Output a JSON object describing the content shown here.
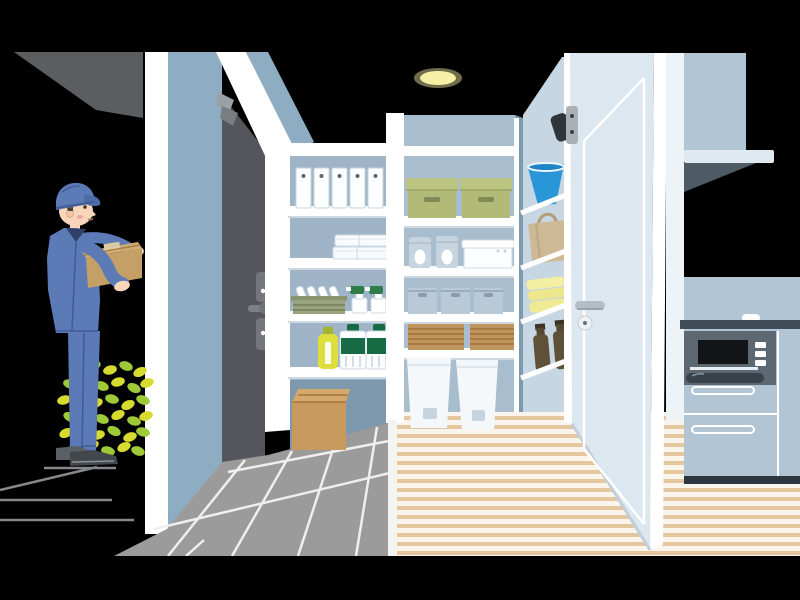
{
  "meta": {
    "type": "flat vector illustration",
    "description": "Delivery worker in blue uniform and cap handing a cardboard parcel at the open dark entrance door of a home; walk-through pantry with stocked white shelving in the center; open white interior door leading to a kitchen with range hood and built-in oven on the right; ceiling downlight glowing above.",
    "canvas": {
      "width": 800,
      "height": 600
    }
  },
  "scene": {
    "exterior": {
      "elements": [
        "dark porch overhang",
        "concrete step edges",
        "green shrub by the step"
      ],
      "person": {
        "role": "delivery-worker",
        "outfit": "blue work jacket, blue trousers, blue cap, dark shoes",
        "holding": "cardboard parcel with packing tape",
        "facing": "right toward the open door"
      }
    },
    "entrance": {
      "door": "dark gray entry door opened outward",
      "hardware": [
        "edge lock cylinders with thumb turns",
        "lever handle",
        "door closer bracket"
      ],
      "floor": "gray tile entryway with white grout lines"
    },
    "pantry": {
      "left_shelf_items": [
        "five white file binders",
        "stacked white storage containers",
        "olive basket with white plates",
        "two spray bottles with green triggers",
        "yellow detergent bottle",
        "two white bottles with green labels",
        "cardboard box on the floor"
      ],
      "center_shelf_items": [
        "two green storage boxes",
        "two soft pouches and a white sealed container",
        "three fabric storage cubes",
        "two woven rattan cases",
        "two white pedal bins on the floor"
      ],
      "corner_shelf_items": [
        "blue bucket",
        "kraft carry bag",
        "three folded yellow towels",
        "two brown bottles"
      ],
      "floor": "pale wood floor with plank stripes",
      "counts": {
        "binders": 5,
        "green_boxes": 2,
        "fabric_cubes": 3,
        "rattan_cases": 2,
        "pedal_bins": 2,
        "towels": 3,
        "brown_bottles": 2,
        "spray_bottles": 2,
        "label_bottles": 2
      }
    },
    "kitchen": {
      "door": "white interior door opened toward viewer with inset panel line, lever handle and round lock",
      "elements": [
        "range hood / upper cabinet",
        "light shelf with dark underside",
        "counter with dark edge",
        "built-in oven with black window and three buttons",
        "drawer fronts with white handle outlines",
        "dark toe kick",
        "striped wood floor"
      ]
    },
    "lighting": "single warm ceiling downlight glow"
  },
  "palette": {
    "background": "#000000",
    "porch_overhang": "#5a5e61",
    "porch_line": "#85898c",
    "exterior_wall_white": "#ffffff",
    "entry_jamb_blue": "#8fadc2",
    "entry_door_dark": "#54565b",
    "door_hardware_gray": "#73767c",
    "pantry_wall": "#a8bdcd",
    "pantry_wall_inner": "#9fb5c7",
    "pantry_wall_shadow": "#7e99ad",
    "corner_column": "#c6d6e2",
    "shelf_white": "#ffffff",
    "shelf_shadow": "#ccd9e2",
    "tile_gray": "#9b9b9b",
    "tile_line": "#efefef",
    "wood_base": "#faf5ec",
    "wood_stripe": "#e5c79f",
    "white_door": "#dde7ef",
    "white_door_edge": "#ffffff",
    "door_handle_silver": "#b4bcc4",
    "kitchen_cabinet": "#b2c5d5",
    "hood_shelf": "#dfe9f0",
    "hood_underside": "#4e5a64",
    "counter_dark": "#3f4d58",
    "oven_face": "#5d6872",
    "oven_window": "#121418",
    "toe_kick": "#2c363e",
    "ceiling_light": "#f6efa6",
    "uniform_blue": "#5b7ab6",
    "uniform_shadow": "#3f5c92",
    "skin": "#f7d6bb",
    "blush": "#f0a89b",
    "shoe_dark": "#43484d",
    "shoe_back": "#5a6066",
    "cardboard": "#c4a067",
    "cardboard_light": "#cfab72",
    "cardboard_tape": "#dccaa4",
    "floor_box": "#c89a5d",
    "floor_box_top": "#d4a96b",
    "leaf_yellow": "#d7db2f",
    "leaf_green": "#9fca38",
    "binder_white": "#fdfeff",
    "box_green": "#b2ba78",
    "box_green_lid": "#bcc481",
    "box_green_slot": "#7f8a54",
    "rice_bag": "#c6d4df",
    "fabric_box": "#b8c9d8",
    "fabric_slot": "#879dad",
    "rattan": "#c0965e",
    "rattan_line": "#a5753f",
    "bin_white": "#f5f8fa",
    "bin_pedal": "#c5d4df",
    "basket_olive": "#99a37d",
    "basket_line": "#7c865f",
    "spray_green": "#2d7c4a",
    "bottle_green": "#176b44",
    "bottle_yellow": "#dfdf3b",
    "bottle_yellow_cap": "#a3b42e",
    "bucket_blue": "#2996d8",
    "kraft_bag": "#cdb996",
    "towel_yellow": "#ece78c",
    "brown_bottle": "#5f5138",
    "metal_gray": "#aab2b8"
  }
}
